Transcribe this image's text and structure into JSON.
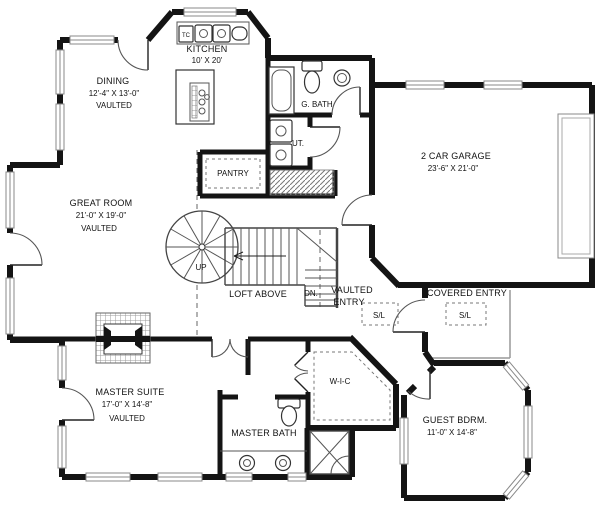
{
  "rooms": {
    "kitchen": {
      "name": "KITCHEN",
      "dims": "10' X 20'"
    },
    "dining": {
      "name": "DINING",
      "dims": "12'-4\" X 13'-0\"",
      "note": "VAULTED"
    },
    "great_room": {
      "name": "GREAT ROOM",
      "dims": "21'-0\" X 19'-0\"",
      "note": "VAULTED"
    },
    "garage": {
      "name": "2 CAR GARAGE",
      "dims": "23'-6\" X 21'-0\""
    },
    "guest_bath": {
      "name": "G. BATH"
    },
    "utility": {
      "name": "UT."
    },
    "pantry": {
      "name": "PANTRY"
    },
    "master_suite": {
      "name": "MASTER SUITE",
      "dims": "17'-0\" X 14'-8\"",
      "note": "VAULTED"
    },
    "master_bath": {
      "name": "MASTER BATH"
    },
    "walk_in_closet": {
      "name": "W-I-C"
    },
    "guest_bedroom": {
      "name": "GUEST BDRM.",
      "dims": "11'-0\" X 14'-8\""
    },
    "covered_entry": {
      "name": "COVERED ENTRY"
    },
    "vaulted_entry": {
      "line1": "VAULTED",
      "line2": "ENTRY"
    }
  },
  "labels": {
    "up": "UP",
    "down": "DN.",
    "loft": "LOFT ABOVE",
    "skylight": "S/L",
    "trash_compactor": "TC"
  },
  "colors": {
    "wall": "#141414",
    "background": "#ffffff",
    "hatch": "#888888"
  }
}
